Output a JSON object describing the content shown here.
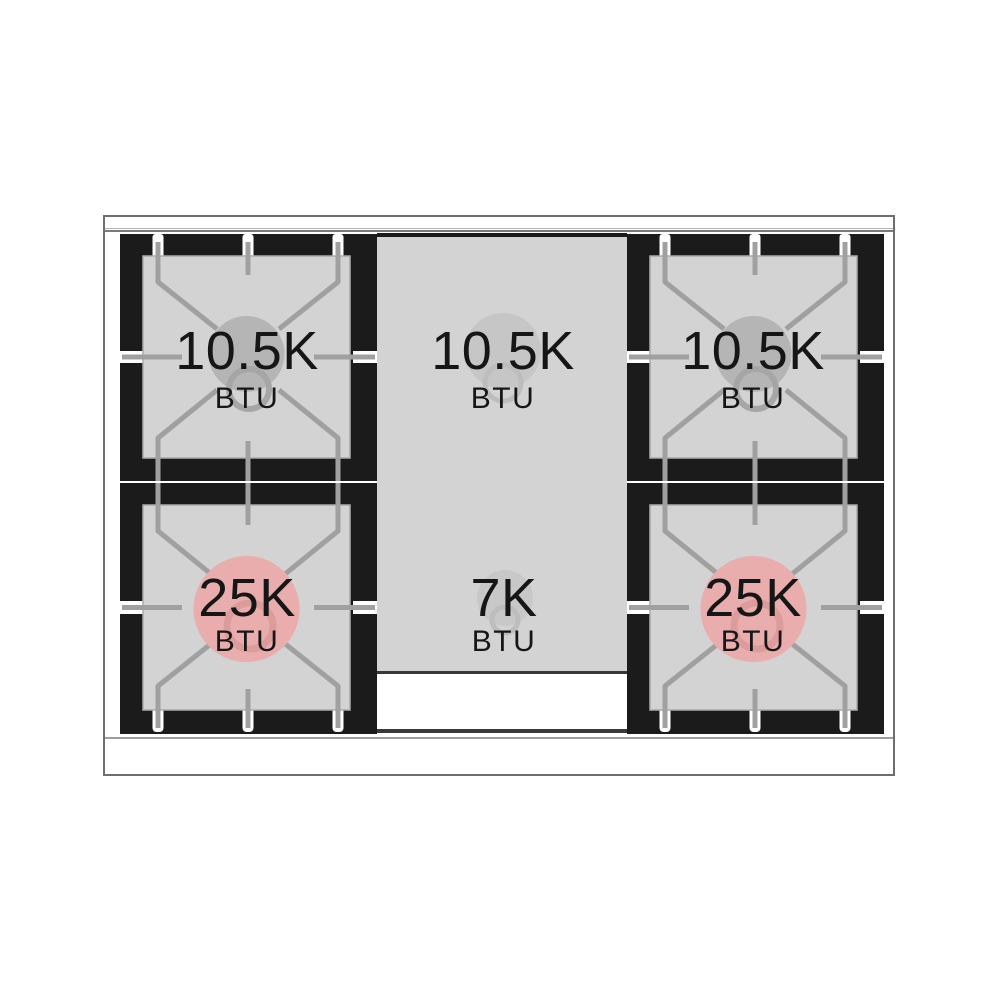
{
  "diagram": {
    "type": "gas-range-cooktop-burner-layout",
    "burners": [
      {
        "position": "top-left",
        "value": "10.5K",
        "unit": "BTU",
        "highlight": "#b5b5b5",
        "ring": "#a6a6a6"
      },
      {
        "position": "top-center",
        "value": "10.5K",
        "unit": "BTU",
        "highlight": "#c6c6c6",
        "ring": "#bdbdbd"
      },
      {
        "position": "top-right",
        "value": "10.5K",
        "unit": "BTU",
        "highlight": "#b5b5b5",
        "ring": "#a6a6a6"
      },
      {
        "position": "bottom-left",
        "value": "25K",
        "unit": "BTU",
        "highlight": "#e9adad",
        "ring": "#dc9c9c"
      },
      {
        "position": "bottom-center",
        "value": "7K",
        "unit": "BTU",
        "highlight": "#c8c8c8",
        "ring": "#bdbdbd"
      },
      {
        "position": "bottom-right",
        "value": "25K",
        "unit": "BTU",
        "highlight": "#e9adad",
        "ring": "#dc9c9c"
      }
    ],
    "colors": {
      "panel_black": "#1b1b1b",
      "surface_gray": "#d3d3d3",
      "grate_line": "#a0a0a0",
      "frame_border": "#6e6e6e",
      "text": "#161616",
      "background": "#ffffff"
    }
  }
}
